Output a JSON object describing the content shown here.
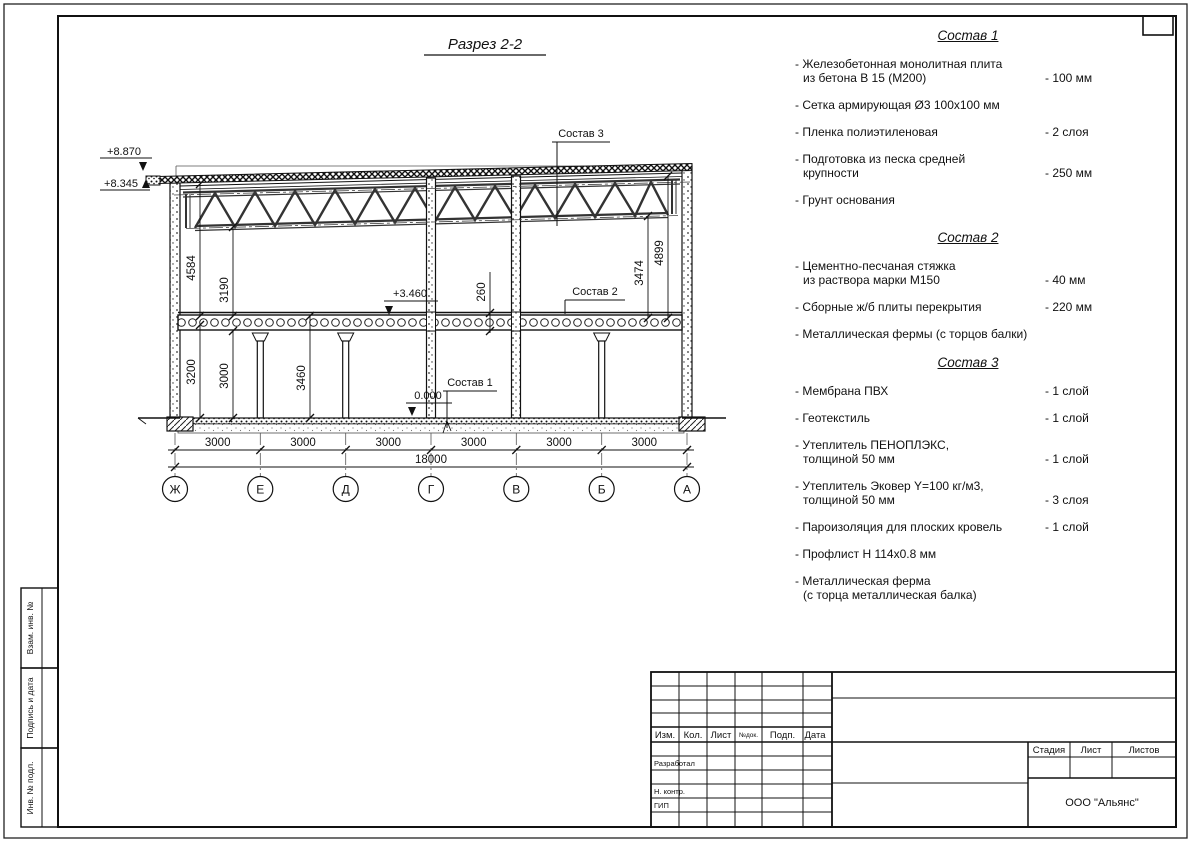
{
  "drawing": {
    "title": "Разрез 2-2",
    "elevations": {
      "top": "+8.870",
      "eaves": "+8.345",
      "floor2": "+3.460",
      "zero": "0.000"
    },
    "left_dims": {
      "d1": "4584",
      "d2": "3190",
      "d3": "3200",
      "d4": "3000",
      "d5": "3460"
    },
    "right_dims": {
      "d1": "260",
      "d2": "3474",
      "d3": "4899"
    },
    "callouts": {
      "c1": "Состав 1",
      "c2": "Состав 2",
      "c3": "Состав 3"
    },
    "axes": [
      "Ж",
      "Е",
      "Д",
      "Г",
      "В",
      "Б",
      "А"
    ],
    "spans": [
      "3000",
      "3000",
      "3000",
      "3000",
      "3000",
      "3000"
    ],
    "total": "18000"
  },
  "compositions": [
    {
      "title": "Состав 1",
      "items": [
        {
          "text": "- Железобетонная монолитная плита\nиз бетона В 15 (М200)",
          "value": "- 100 мм"
        },
        {
          "text": "- Сетка армирующая Ø3 100х100 мм",
          "value": ""
        },
        {
          "text": "- Пленка полиэтиленовая",
          "value": "- 2 слоя"
        },
        {
          "text": "- Подготовка из песка средней\nкрупности",
          "value": "- 250 мм"
        },
        {
          "text": "- Грунт основания",
          "value": ""
        }
      ]
    },
    {
      "title": "Состав 2",
      "items": [
        {
          "text": "- Цементно-песчаная стяжка\nиз раствора марки М150",
          "value": "- 40 мм"
        },
        {
          "text": "- Сборные ж/б плиты перекрытия",
          "value": "- 220 мм"
        },
        {
          "text": "- Металлическая фермы (с торцов балки)",
          "value": ""
        }
      ]
    },
    {
      "title": "Состав 3",
      "items": [
        {
          "text": "- Мембрана ПВХ",
          "value": "- 1 слой"
        },
        {
          "text": "- Геотекстиль",
          "value": "- 1 слой"
        },
        {
          "text": "- Утеплитель ПЕНОПЛЭКС,\nтолщиной 50 мм",
          "value": "- 1 слой"
        },
        {
          "text": "- Утеплитель Эковер Y=100 кг/м3,\nтолщиной 50 мм",
          "value": "- 3 слоя"
        },
        {
          "text": "- Пароизоляция для плоских кровель",
          "value": "- 1 слой"
        },
        {
          "text": "- Профлист Н 114х0.8 мм",
          "value": ""
        },
        {
          "text": "- Металлическая ферма\n(с торца металлическая балка)",
          "value": ""
        }
      ]
    }
  ],
  "frame_sidebar": {
    "s1": "Взам. инв. №",
    "s2": "Подпись и дата",
    "s3": "Инв. № подл."
  },
  "titleblock": {
    "header_cols": [
      "Изм.",
      "Кол.",
      "Лист",
      "№док.",
      "Подп.",
      "Дата"
    ],
    "role_rows": [
      "Разработал",
      "Н. контр.",
      "ГИП"
    ],
    "stage_cols": [
      "Стадия",
      "Лист",
      "Листов"
    ],
    "company": "ООО \"Альянс\""
  }
}
